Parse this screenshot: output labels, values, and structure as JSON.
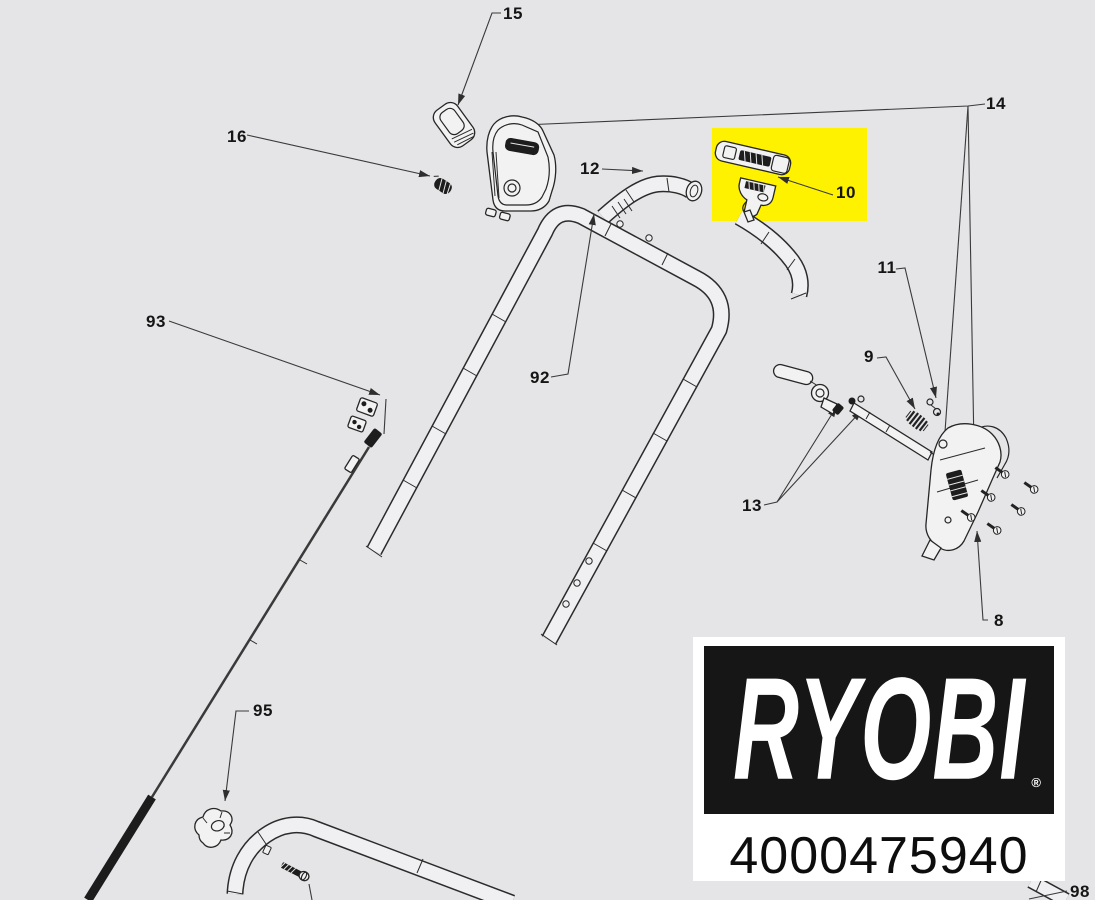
{
  "colors": {
    "background": "#e5e5e7",
    "highlight": "#fff200",
    "leader_line": "#3a3a3a",
    "ink": "#161616"
  },
  "callouts": [
    {
      "part": "15",
      "x": 513,
      "y": 14
    },
    {
      "part": "16",
      "x": 237,
      "y": 137
    },
    {
      "part": "12",
      "x": 590,
      "y": 169
    },
    {
      "part": "10",
      "x": 846,
      "y": 193
    },
    {
      "part": "14",
      "x": 996,
      "y": 104
    },
    {
      "part": "11",
      "x": 887,
      "y": 268
    },
    {
      "part": "9",
      "x": 869,
      "y": 357
    },
    {
      "part": "13",
      "x": 752,
      "y": 506
    },
    {
      "part": "8",
      "x": 999,
      "y": 621
    },
    {
      "part": "92",
      "x": 540,
      "y": 378
    },
    {
      "part": "93",
      "x": 156,
      "y": 322
    },
    {
      "part": "95",
      "x": 263,
      "y": 711
    },
    {
      "part": "98",
      "x": 1080,
      "y": 892
    }
  ],
  "highlighted_part": "10",
  "brand": {
    "name": "RYOBI",
    "registered": "®",
    "sku": "4000475940"
  }
}
